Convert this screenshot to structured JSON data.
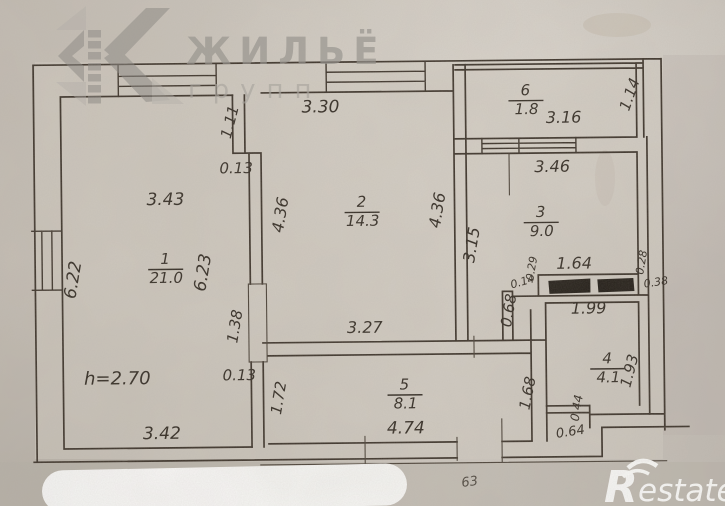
{
  "logo": {
    "brand_top": "ЖИЛЬЁ",
    "brand_bottom": "групп"
  },
  "watermark": {
    "brand_r": "R",
    "brand_rest": "estate",
    "note": "63"
  },
  "plan": {
    "ceiling_height": "h=2.70",
    "rooms": [
      {
        "num": "1",
        "area": "21.0",
        "x": 165,
        "y": 262
      },
      {
        "num": "2",
        "area": "14.3",
        "x": 362,
        "y": 207
      },
      {
        "num": "3",
        "area": "9.0",
        "x": 541,
        "y": 219
      },
      {
        "num": "4",
        "area": "4.1",
        "x": 606,
        "y": 366
      },
      {
        "num": "5",
        "area": "8.1",
        "x": 403,
        "y": 390
      },
      {
        "num": "6",
        "area": "1.8",
        "x": 527,
        "y": 97
      }
    ],
    "dimensions": [
      {
        "t": "3.30",
        "x": 322,
        "y": 112,
        "s": 17
      },
      {
        "t": "1.11",
        "x": 236,
        "y": 122,
        "s": 15,
        "r": -75
      },
      {
        "t": "0.13",
        "x": 237,
        "y": 172,
        "s": 15
      },
      {
        "t": "3.43",
        "x": 166,
        "y": 203,
        "s": 17
      },
      {
        "t": "4.36",
        "x": 286,
        "y": 215,
        "s": 16,
        "r": -80
      },
      {
        "t": "4.36",
        "x": 443,
        "y": 212,
        "s": 16,
        "r": -80
      },
      {
        "t": "6.22",
        "x": 78,
        "y": 278,
        "s": 17,
        "r": -80
      },
      {
        "t": "6.23",
        "x": 208,
        "y": 272,
        "s": 17,
        "r": -80
      },
      {
        "t": "1.38",
        "x": 239,
        "y": 326,
        "s": 15,
        "r": -80
      },
      {
        "t": "0.13",
        "x": 238,
        "y": 379,
        "s": 15
      },
      {
        "t": "h=2.70",
        "x": 116,
        "y": 382,
        "s": 18
      },
      {
        "t": "3.42",
        "x": 160,
        "y": 437,
        "s": 17
      },
      {
        "t": "3.27",
        "x": 364,
        "y": 333,
        "s": 16
      },
      {
        "t": "1.72",
        "x": 282,
        "y": 398,
        "s": 15,
        "r": -80
      },
      {
        "t": "4.74",
        "x": 404,
        "y": 434,
        "s": 17
      },
      {
        "t": "3.16",
        "x": 565,
        "y": 125,
        "s": 16
      },
      {
        "t": "1.14",
        "x": 636,
        "y": 99,
        "s": 15,
        "r": -70
      },
      {
        "t": "3.46",
        "x": 553,
        "y": 174,
        "s": 16
      },
      {
        "t": "3.15",
        "x": 477,
        "y": 247,
        "s": 16,
        "r": -80
      },
      {
        "t": "1.64",
        "x": 574,
        "y": 271,
        "s": 16
      },
      {
        "t": "0.29",
        "x": 535,
        "y": 271,
        "s": 11,
        "r": -80
      },
      {
        "t": "0.14",
        "x": 523,
        "y": 287,
        "s": 11,
        "r": -15
      },
      {
        "t": "0.28",
        "x": 645,
        "y": 266,
        "s": 11,
        "r": -80
      },
      {
        "t": "0.38",
        "x": 656,
        "y": 289,
        "s": 11,
        "r": -8
      },
      {
        "t": "0.68",
        "x": 513,
        "y": 313,
        "s": 15,
        "r": -80
      },
      {
        "t": "1.99",
        "x": 588,
        "y": 316,
        "s": 16
      },
      {
        "t": "1.93",
        "x": 633,
        "y": 375,
        "s": 15,
        "r": -75
      },
      {
        "t": "0.44",
        "x": 579,
        "y": 411,
        "s": 12,
        "r": -80
      },
      {
        "t": "0.64",
        "x": 569,
        "y": 438,
        "s": 13,
        "r": -8
      },
      {
        "t": "1.68",
        "x": 531,
        "y": 396,
        "s": 15,
        "r": -78
      }
    ]
  }
}
